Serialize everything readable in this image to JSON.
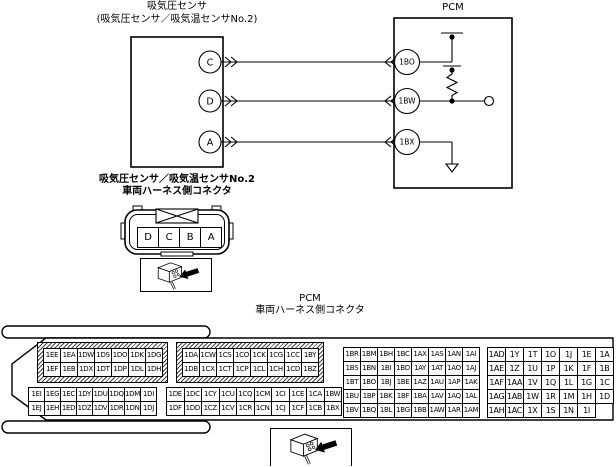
{
  "colors": {
    "line": "#000000",
    "background": "#ffffff"
  },
  "icons": {
    "connector_plug": "plug-with-arrow-icon"
  },
  "schematic": {
    "sensor_title_line1": "吸気圧センサ",
    "sensor_title_line2": "(吸気圧センサ／吸気温センサNo.2)",
    "pcm_title": "PCM",
    "sensor_pins": [
      "C",
      "D",
      "A"
    ],
    "pcm_pins": [
      "1BO",
      "1BW",
      "1BX"
    ]
  },
  "sensor_connector": {
    "label_line1": "吸気圧センサ／吸気温センサNo.2",
    "label_line2": "車両ハーネス側コネクタ",
    "pin_rows": [
      [
        "D",
        "C",
        "B",
        "A"
      ]
    ]
  },
  "pcm_connector": {
    "label_line1": "PCM",
    "label_line2": "車両ハーネス側コネクタ",
    "groups": [
      {
        "name": "top-left",
        "hatched": true,
        "rows": [
          [
            "1EE",
            "1EA",
            "1DW",
            "1DS",
            "1DO",
            "1DK",
            "1DG"
          ],
          [
            "1EF",
            "1EB",
            "1DX",
            "1DT",
            "1DP",
            "1DL",
            "1DH"
          ]
        ]
      },
      {
        "name": "top-middle",
        "hatched": true,
        "rows": [
          [
            "1DA",
            "1CW",
            "1CS",
            "1CO",
            "1CK",
            "1CG",
            "1CC",
            "1BY"
          ],
          [
            "1DB",
            "1CX",
            "1CT",
            "1CP",
            "1CL",
            "1CH",
            "1CD",
            "1BZ"
          ]
        ]
      },
      {
        "name": "right-inner",
        "hatched": false,
        "rows": [
          [
            "1BR",
            "1BM",
            "1BH",
            "1BC",
            "1AX",
            "1AS",
            "1AN",
            "1AI"
          ],
          [
            "1BS",
            "1BN",
            "1BI",
            "1BD",
            "1AY",
            "1AT",
            "1AO",
            "1AJ"
          ],
          [
            "1BT",
            "1BO",
            "1BJ",
            "1BE",
            "1AZ",
            "1AU",
            "1AP",
            "1AK"
          ],
          [
            "1BU",
            "1BP",
            "1BK",
            "1BF",
            "1BA",
            "1AV",
            "1AQ",
            "1AL"
          ],
          [
            "1BV",
            "1BQ",
            "1BL",
            "1BG",
            "1BB",
            "1AW",
            "1AR",
            "1AM"
          ]
        ]
      },
      {
        "name": "right-outer",
        "hatched": false,
        "rows": [
          [
            "1AD",
            "1Y",
            "1T",
            "1O",
            "1J",
            "1E",
            "1A"
          ],
          [
            "1AE",
            "1Z",
            "1U",
            "1P",
            "1K",
            "1F",
            "1B"
          ],
          [
            "1AF",
            "1AA",
            "1V",
            "1Q",
            "1L",
            "1G",
            "1C"
          ],
          [
            "1AG",
            "1AB",
            "1W",
            "1R",
            "1M",
            "1H",
            "1D"
          ],
          [
            "1AH",
            "1AC",
            "1X",
            "1S",
            "1N",
            "1I"
          ]
        ]
      },
      {
        "name": "bottom-left",
        "hatched": false,
        "rows": [
          [
            "1EI",
            "1EG",
            "1EC",
            "1DY",
            "1DU",
            "1DQ",
            "1DM",
            "1DI"
          ],
          [
            "1EJ",
            "1EH",
            "1ED",
            "1DZ",
            "1DV",
            "1DR",
            "1DN",
            "1DJ"
          ]
        ]
      },
      {
        "name": "bottom-middle",
        "hatched": false,
        "rows": [
          [
            "1DE",
            "1DC",
            "1CY",
            "1CU",
            "1CQ",
            "1CM",
            "1CI",
            "1CE",
            "1CA",
            "1BW"
          ],
          [
            "1DF",
            "1DD",
            "1CZ",
            "1CV",
            "1CR",
            "1CN",
            "1CJ",
            "1CF",
            "1CB",
            "1BX"
          ]
        ]
      }
    ]
  }
}
